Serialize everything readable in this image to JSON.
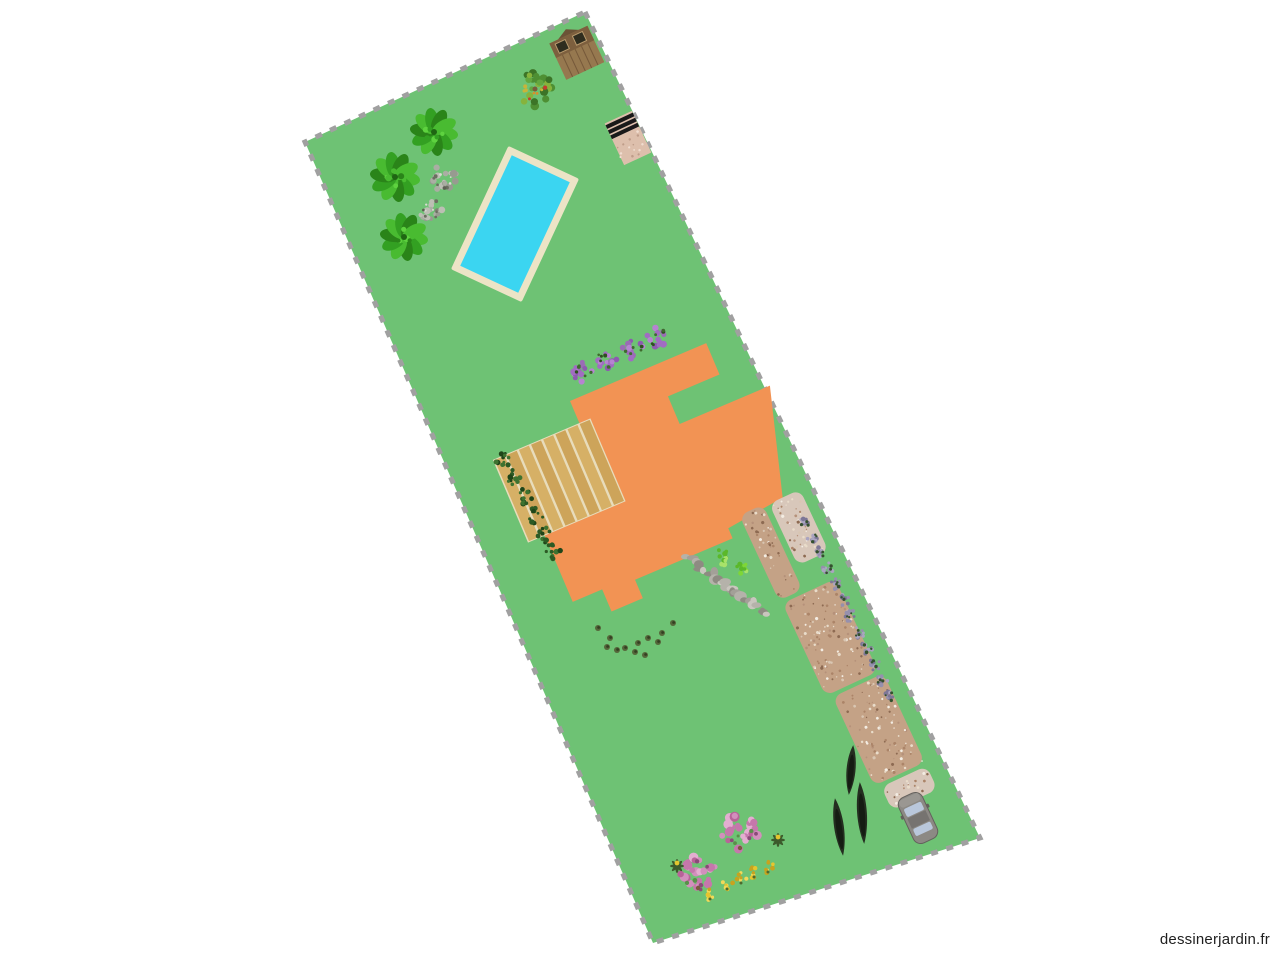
{
  "watermark": {
    "text": "dessinerjardin.fr",
    "color": "#1f1f1f"
  },
  "canvas": {
    "width": 1280,
    "height": 960,
    "background": "#ffffff"
  },
  "plot": {
    "points": [
      [
        585,
        12
      ],
      [
        980,
        838
      ],
      [
        653,
        943
      ],
      [
        305,
        142
      ]
    ],
    "fill": "#6ec274",
    "stroke": "#a0a0a0",
    "stroke_width": 5,
    "dash": "7 9"
  },
  "palettes": {
    "palm": [
      "#49bb31",
      "#33a022",
      "#2a8419",
      "#5ed23f"
    ],
    "gray": [
      "#979b90",
      "#aaaea3",
      "#808476",
      "#bcbfb4"
    ],
    "grayDark": [
      "#5c6052",
      "#6b6f60"
    ],
    "apple": [
      "#4e8f33",
      "#63a73f",
      "#3c7427",
      "#86b33c"
    ],
    "fruit": [
      "#c53c2e",
      "#d98f2b",
      "#c8b43a"
    ],
    "lilac": [
      "#a16cc2",
      "#8d5bb0",
      "#b683d1",
      "#9a6cb5"
    ],
    "lilacGreen": [
      "#3f6b2e",
      "#2e511f"
    ],
    "vine": [
      "#2c5a24",
      "#3e7230",
      "#1f4519"
    ],
    "lavender": [
      "#9690ad",
      "#7d7696",
      "#aaa4c0"
    ],
    "lavenderGreen": [
      "#34502e"
    ],
    "pink": [
      "#d28fbc",
      "#c577ab",
      "#e3aed0",
      "#b86398"
    ],
    "pinkGreen": [
      "#5a8f4a",
      "#8a4a78"
    ],
    "stone": [
      "#a3a098",
      "#8e8b82",
      "#b5b2aa",
      "#c9c6be"
    ],
    "gravelSpeck": [
      "#e9dcca",
      "#ab8468",
      "#d9c6b2",
      "#b5917a",
      "#f3ece2",
      "#8d6a52"
    ],
    "greenBush": [
      "#7ed637",
      "#5bb82a",
      "#a8e26a"
    ],
    "yellow": [
      "#e7c52e",
      "#c7a31f",
      "#f2d95a"
    ]
  },
  "objects": {
    "house": {
      "x": 570,
      "y": 401,
      "rotate": -23,
      "fill": "#f29354",
      "points": [
        [
          0,
          0
        ],
        [
          148,
          0
        ],
        [
          148,
          34
        ],
        [
          92,
          34
        ],
        [
          92,
          64
        ],
        [
          190,
          64
        ],
        [
          158,
          172
        ],
        [
          96,
          179
        ],
        [
          96,
          190
        ],
        [
          -10,
          190
        ],
        [
          -10,
          210
        ],
        [
          -44,
          210
        ],
        [
          -44,
          186
        ],
        [
          -76,
          186
        ],
        [
          -76,
          108
        ],
        [
          0,
          108
        ]
      ]
    },
    "deck": {
      "x": 570,
      "y": 401,
      "rotate": -23,
      "left": -94,
      "top": 24,
      "width": 106,
      "height": 90,
      "base": "#e8dcbb",
      "planks": [
        "#d6b066",
        "#cda45a"
      ],
      "plank_width": 10.8,
      "step": 13.2
    },
    "pool": {
      "x": 515,
      "y": 224,
      "rotate": 25,
      "width": 78,
      "height": 136,
      "border": 7,
      "border_color": "#ece4c6",
      "water": "#3bd5f1"
    },
    "shed": {
      "x": 576,
      "y": 51,
      "rotate": -25,
      "width": 42,
      "height": 44,
      "body": "#96784f",
      "band": "#7d5f3e",
      "peak": "#6b5236",
      "window": "#2f2d1f",
      "frame": "#b99b6e",
      "plank_line": "#76593a"
    },
    "patio_bbq": {
      "x": 628,
      "y": 138,
      "rotate": -25,
      "width": 30,
      "height": 46,
      "base": "#ddbfac",
      "stripe": "#191919",
      "speck": [
        "#bf9d8a",
        "#f0ddd0"
      ]
    },
    "driveway": {
      "x": 742,
      "y": 512,
      "rotate": -25,
      "base": "#c4a286",
      "light": "#d8c7ba",
      "segments": [
        {
          "x": -4,
          "y": 2,
          "w": 26,
          "h": 94,
          "tone": "base"
        },
        {
          "x": 28,
          "y": 4,
          "w": 34,
          "h": 68,
          "tone": "light"
        },
        {
          "x": -2,
          "y": 100,
          "w": 58,
          "h": 102,
          "tone": "base"
        },
        {
          "x": 4,
          "y": 206,
          "w": 56,
          "h": 98,
          "tone": "base"
        },
        {
          "x": 10,
          "y": 308,
          "w": 50,
          "h": 26,
          "tone": "light"
        }
      ]
    },
    "car": {
      "x": 918,
      "y": 818,
      "rotate": -25,
      "width": 26,
      "height": 50,
      "body": "#8c8984",
      "outline": "#63605c",
      "roof": "#767370",
      "glass": "#b9c7db",
      "hood": "#9a9792"
    },
    "stone_paths": [
      {
        "x1": 687,
        "y1": 558,
        "x2": 731,
        "y2": 587,
        "r": 9,
        "seed": 11
      },
      {
        "x1": 727,
        "y1": 588,
        "x2": 769,
        "y2": 613,
        "r": 9,
        "seed": 23
      }
    ],
    "cypresses": [
      {
        "x": 839,
        "y": 827,
        "w": 13,
        "h": 58,
        "rotate": -8
      },
      {
        "x": 851,
        "y": 770,
        "w": 12,
        "h": 50,
        "rotate": 5
      },
      {
        "x": 862,
        "y": 813,
        "w": 13,
        "h": 62,
        "rotate": -4
      }
    ],
    "cypress_fill": "#242e20",
    "cypress_core": "#151c13",
    "palm_trees": [
      {
        "x": 434,
        "y": 132,
        "r": 22,
        "seed": 3
      },
      {
        "x": 395,
        "y": 177,
        "r": 23,
        "seed": 5
      },
      {
        "x": 404,
        "y": 237,
        "r": 22,
        "seed": 9
      }
    ],
    "gray_bushes": [
      {
        "x": 444,
        "y": 178,
        "r": 13,
        "seed": 31
      },
      {
        "x": 431,
        "y": 209,
        "r": 12,
        "seed": 37
      }
    ],
    "apple_tree": {
      "x": 535,
      "y": 89,
      "r": 17,
      "seed": 41
    },
    "lilac_bushes": [
      {
        "x": 582,
        "y": 371,
        "r": 11,
        "seed": 51
      },
      {
        "x": 607,
        "y": 359,
        "r": 11,
        "seed": 53
      },
      {
        "x": 633,
        "y": 348,
        "r": 11,
        "seed": 57
      },
      {
        "x": 658,
        "y": 337,
        "r": 11,
        "seed": 59
      }
    ],
    "vine_plants": [
      {
        "x": 503,
        "y": 459
      },
      {
        "x": 513,
        "y": 478
      },
      {
        "x": 524,
        "y": 497
      },
      {
        "x": 535,
        "y": 516
      },
      {
        "x": 546,
        "y": 535
      },
      {
        "x": 553,
        "y": 551
      }
    ],
    "green_bushes": [
      {
        "x": 722,
        "y": 557,
        "r": 8,
        "seed": 61
      },
      {
        "x": 741,
        "y": 569,
        "r": 7,
        "seed": 67
      }
    ],
    "lavender_row": {
      "x0": 805,
      "y0": 521,
      "dx": 7.7,
      "dy": 15.9,
      "count": 12,
      "r": 6
    },
    "ground_dots": [
      [
        598,
        628
      ],
      [
        610,
        638
      ],
      [
        607,
        647
      ],
      [
        617,
        650
      ],
      [
        625,
        648
      ],
      [
        635,
        652
      ],
      [
        638,
        643
      ],
      [
        648,
        638
      ],
      [
        658,
        642
      ],
      [
        662,
        633
      ],
      [
        673,
        623
      ],
      [
        645,
        655
      ]
    ],
    "ground_dot_fill": "#55663a",
    "ground_dot_core": "#333f22",
    "pink_trees": [
      {
        "x": 698,
        "y": 872,
        "r": 18,
        "seed": 71
      },
      {
        "x": 740,
        "y": 831,
        "r": 19,
        "seed": 73
      }
    ],
    "yellow_flowers": [
      {
        "x": 710,
        "y": 894
      },
      {
        "x": 727,
        "y": 884
      },
      {
        "x": 741,
        "y": 878
      },
      {
        "x": 754,
        "y": 872
      },
      {
        "x": 768,
        "y": 867
      }
    ],
    "yellow_top_plants": [
      {
        "x": 677,
        "y": 866
      },
      {
        "x": 778,
        "y": 840
      }
    ]
  }
}
